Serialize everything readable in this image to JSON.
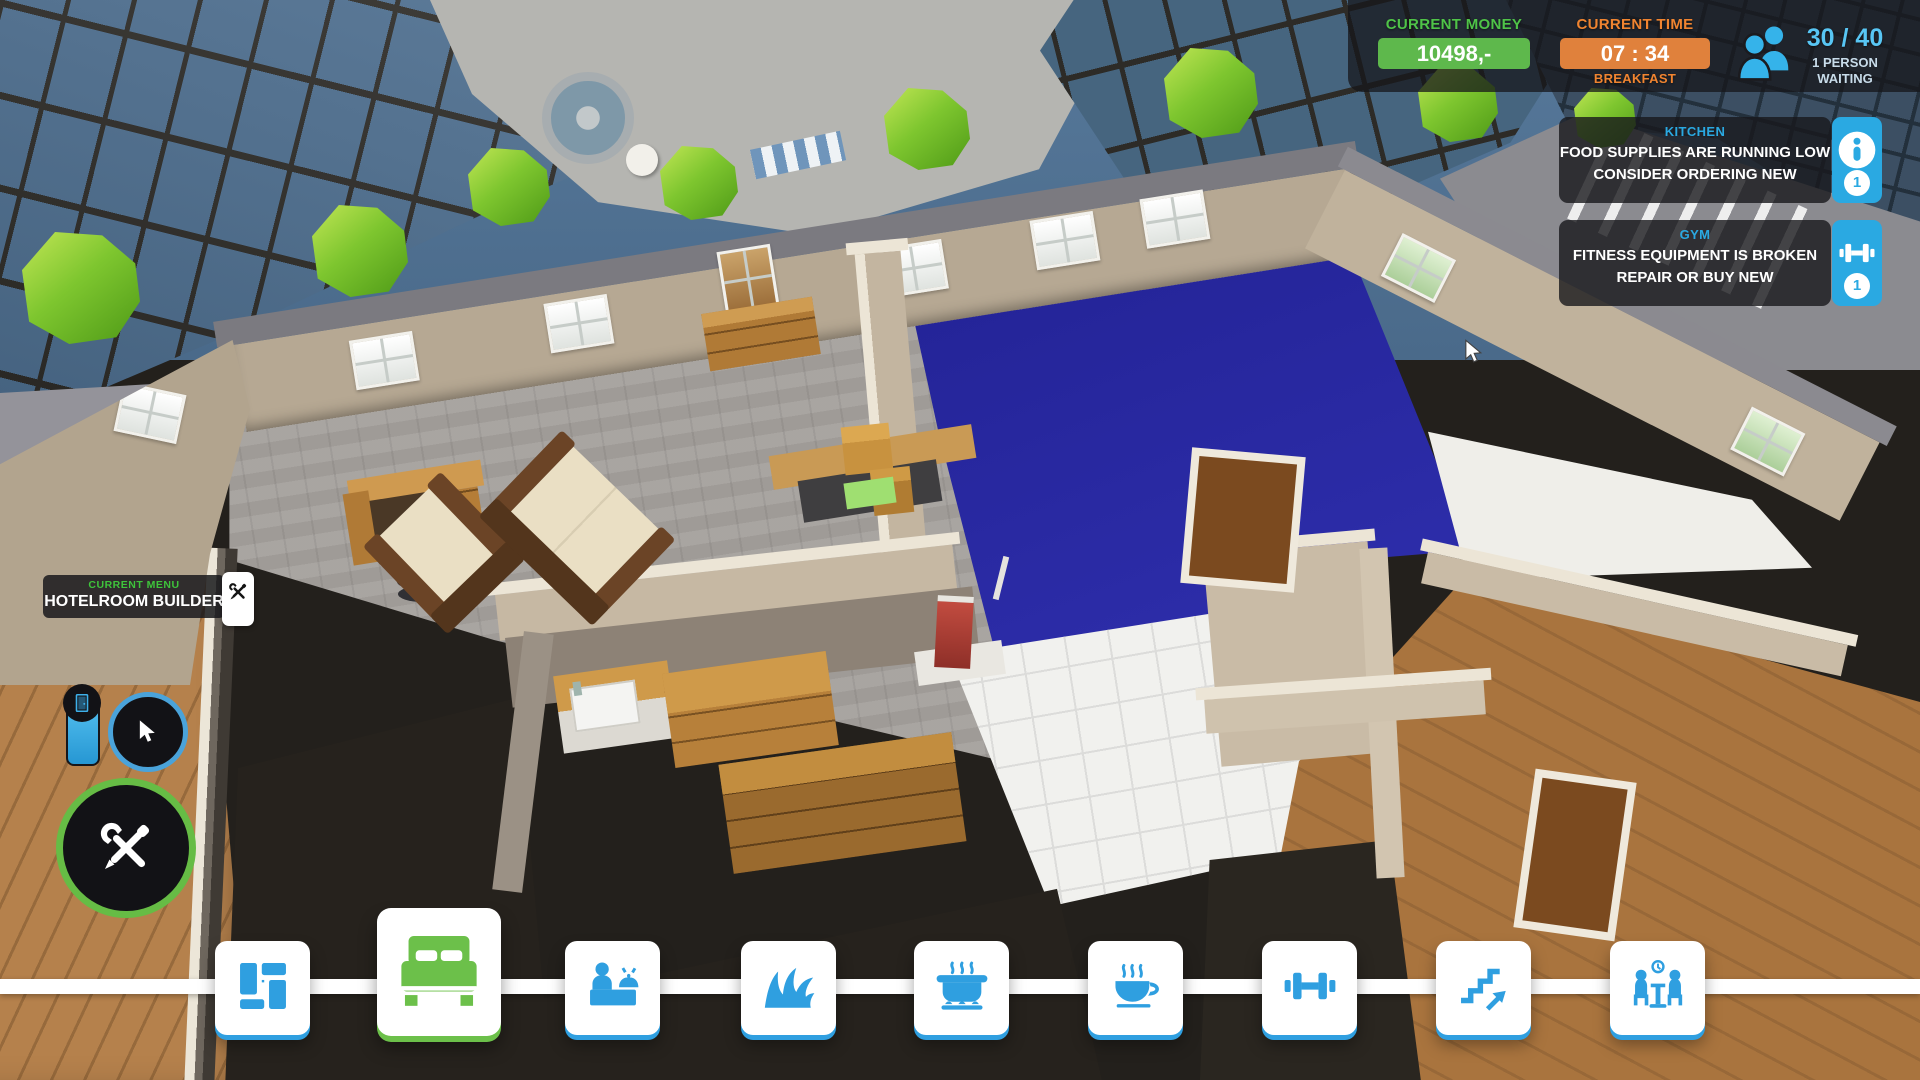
{
  "hud": {
    "money": {
      "label": "CURRENT MONEY",
      "value": "10498,-"
    },
    "time": {
      "label": "CURRENT TIME",
      "value": "07 : 34",
      "period": "BREAKFAST"
    },
    "guests": {
      "count": "30 / 40",
      "line1": "1 PERSON",
      "line2": "WAITING",
      "icon": "people-icon"
    }
  },
  "notifications": [
    {
      "category": "KITCHEN",
      "line1": "FOOD SUPPLIES ARE RUNNING LOW",
      "line2": "CONSIDER ORDERING NEW",
      "icon": "info-icon",
      "badge": "1"
    },
    {
      "category": "GYM",
      "line1": "FITNESS EQUIPMENT IS BROKEN",
      "line2": "REPAIR OR BUY NEW",
      "icon": "dumbbell-icon",
      "badge": "1"
    }
  ],
  "current_menu": {
    "label": "CURRENT MENU",
    "value": "HOTELROOM BUILDER",
    "icon": "tools-icon"
  },
  "side_tools": [
    {
      "id": "door",
      "icon": "door-icon"
    },
    {
      "id": "select",
      "icon": "cursor-icon"
    },
    {
      "id": "build",
      "icon": "tools-icon"
    }
  ],
  "toolbar": {
    "items": [
      {
        "id": "floorplan",
        "icon": "floorplan-icon",
        "active": false
      },
      {
        "id": "bedroom",
        "icon": "bed-icon",
        "active": true
      },
      {
        "id": "reception",
        "icon": "reception-icon",
        "active": false
      },
      {
        "id": "garden",
        "icon": "grass-icon",
        "active": false
      },
      {
        "id": "kitchen",
        "icon": "cooking-pot-icon",
        "active": false
      },
      {
        "id": "cafe",
        "icon": "coffee-icon",
        "active": false
      },
      {
        "id": "gym",
        "icon": "dumbbell-icon",
        "active": false
      },
      {
        "id": "stairs",
        "icon": "stairs-icon",
        "active": false
      },
      {
        "id": "restaurant",
        "icon": "dining-icon",
        "active": false
      }
    ]
  },
  "colors": {
    "money_green": "#5eb84c",
    "time_orange": "#e0813c",
    "hud_blue": "#35b3ea",
    "notif_blue": "#2aa9e2",
    "toolbar_blue": "#2f9fe0",
    "active_green": "#6cc04a",
    "menu_green": "#3ec43b",
    "pool_blue": "#2a2aa3",
    "panel_dark": "rgba(24,24,27,0.8)"
  }
}
